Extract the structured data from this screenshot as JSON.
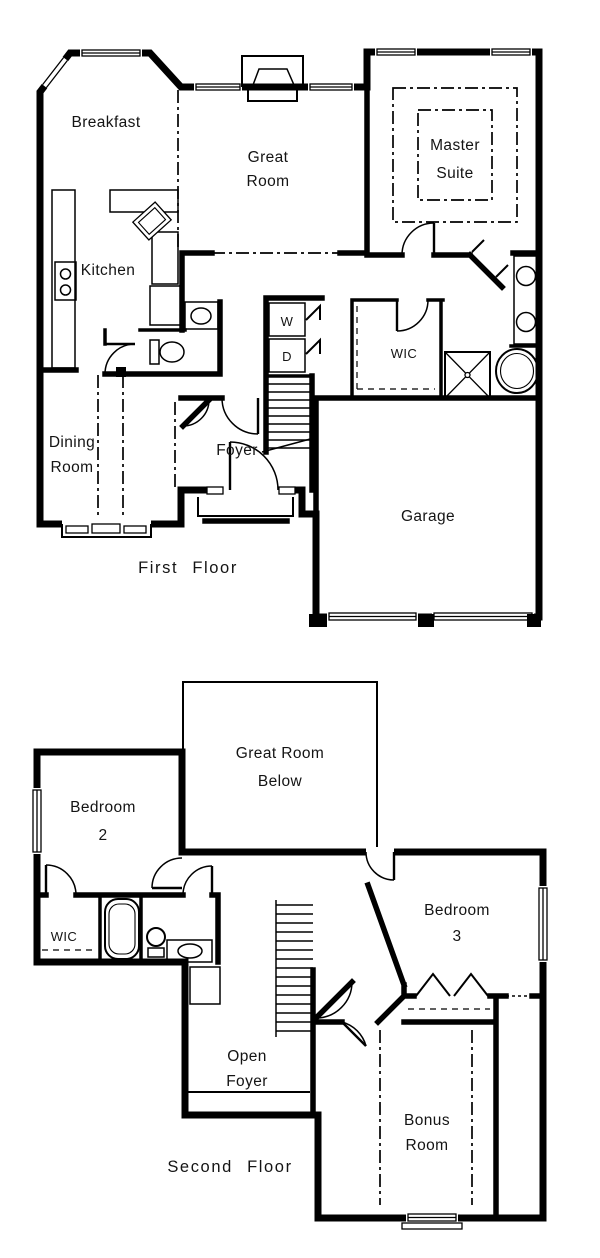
{
  "page": {
    "type": "architectural-floor-plan",
    "background_color": "#ffffff",
    "line_color": "#000000"
  },
  "first_floor": {
    "caption": "First Floor",
    "rooms": {
      "breakfast": "Breakfast",
      "great_room": [
        "Great",
        "Room"
      ],
      "master_suite": [
        "Master",
        "Suite"
      ],
      "kitchen": "Kitchen",
      "washer": "W",
      "dryer": "D",
      "walk_in_closet": "WIC",
      "dining_room": [
        "Dining",
        "Room"
      ],
      "foyer": "Foyer",
      "garage": "Garage"
    }
  },
  "second_floor": {
    "caption": "Second Floor",
    "rooms": {
      "great_room_below": [
        "Great Room",
        "Below"
      ],
      "bedroom_2": [
        "Bedroom",
        "2"
      ],
      "walk_in_closet": "WIC",
      "bedroom_3": [
        "Bedroom",
        "3"
      ],
      "open_foyer": [
        "Open",
        "Foyer"
      ],
      "bonus_room": [
        "Bonus",
        "Room"
      ]
    }
  }
}
